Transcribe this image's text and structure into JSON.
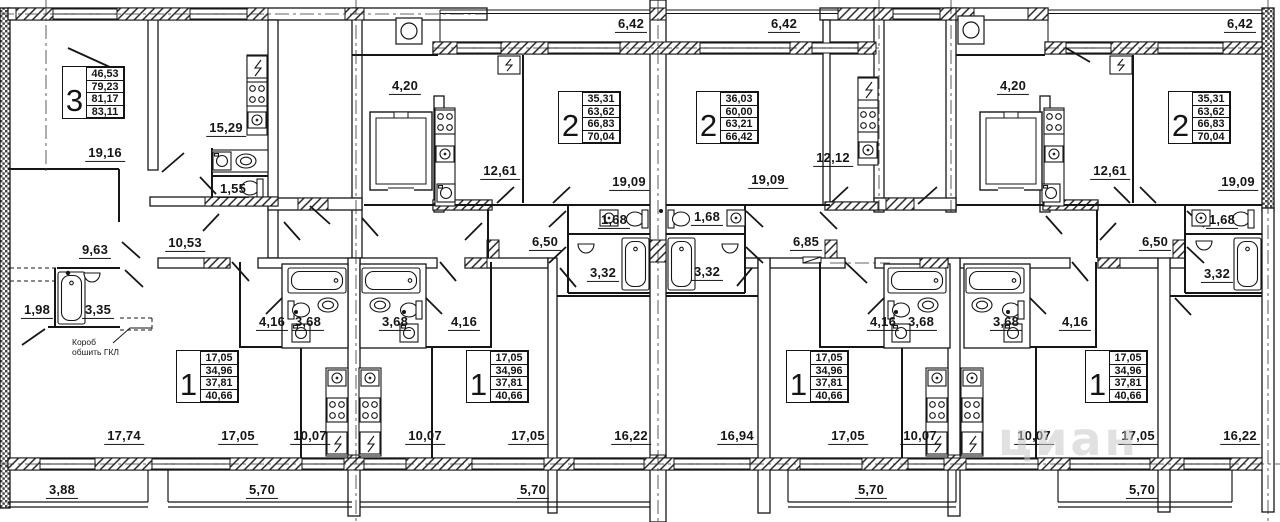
{
  "plan": {
    "title": "Floor plan with apartment layouts",
    "apartment_tables": [
      {
        "number": "3",
        "areas": [
          "46,53",
          "79,23",
          "81,17",
          "83,11"
        ],
        "x": 62,
        "y": 66
      },
      {
        "number": "2",
        "areas": [
          "35,31",
          "63,62",
          "66,83",
          "70,04"
        ],
        "x": 558,
        "y": 91
      },
      {
        "number": "2",
        "areas": [
          "36,03",
          "60,00",
          "63,21",
          "66,42"
        ],
        "x": 696,
        "y": 91
      },
      {
        "number": "2",
        "areas": [
          "35,31",
          "63,62",
          "66,83",
          "70,04"
        ],
        "x": 1168,
        "y": 91
      },
      {
        "number": "1",
        "areas": [
          "17,05",
          "34,96",
          "37,81",
          "40,66"
        ],
        "x": 176,
        "y": 350
      },
      {
        "number": "1",
        "areas": [
          "17,05",
          "34,96",
          "37,81",
          "40,66"
        ],
        "x": 466,
        "y": 350
      },
      {
        "number": "1",
        "areas": [
          "17,05",
          "34,96",
          "37,81",
          "40,66"
        ],
        "x": 786,
        "y": 350
      },
      {
        "number": "1",
        "areas": [
          "17,05",
          "34,96",
          "37,81",
          "40,66"
        ],
        "x": 1085,
        "y": 350
      }
    ],
    "dimension_labels": [
      {
        "text": "6,42",
        "x": 631,
        "y": 26
      },
      {
        "text": "6,42",
        "x": 784,
        "y": 26
      },
      {
        "text": "6,42",
        "x": 1240,
        "y": 26
      },
      {
        "text": "4,20",
        "x": 405,
        "y": 88
      },
      {
        "text": "4,20",
        "x": 1013,
        "y": 88
      },
      {
        "text": "15,29",
        "x": 226,
        "y": 130
      },
      {
        "text": "12,61",
        "x": 500,
        "y": 173
      },
      {
        "text": "12,12",
        "x": 833,
        "y": 160
      },
      {
        "text": "12,61",
        "x": 1110,
        "y": 173
      },
      {
        "text": "19,16",
        "x": 105,
        "y": 155
      },
      {
        "text": "19,09",
        "x": 629,
        "y": 184
      },
      {
        "text": "19,09",
        "x": 768,
        "y": 182
      },
      {
        "text": "19,09",
        "x": 1238,
        "y": 184
      },
      {
        "text": "1,55",
        "x": 233,
        "y": 191
      },
      {
        "text": "1,68",
        "x": 614,
        "y": 222
      },
      {
        "text": "1,68",
        "x": 707,
        "y": 219
      },
      {
        "text": "1,68",
        "x": 1222,
        "y": 222
      },
      {
        "text": "10,53",
        "x": 185,
        "y": 245
      },
      {
        "text": "9,63",
        "x": 95,
        "y": 252
      },
      {
        "text": "6,50",
        "x": 545,
        "y": 244
      },
      {
        "text": "6,85",
        "x": 806,
        "y": 244
      },
      {
        "text": "6,50",
        "x": 1155,
        "y": 244
      },
      {
        "text": "3,32",
        "x": 603,
        "y": 275
      },
      {
        "text": "3,32",
        "x": 707,
        "y": 274
      },
      {
        "text": "3,32",
        "x": 1217,
        "y": 276
      },
      {
        "text": "1,98",
        "x": 37,
        "y": 312
      },
      {
        "text": "3,35",
        "x": 98,
        "y": 312
      },
      {
        "text": "4,16",
        "x": 272,
        "y": 324
      },
      {
        "text": "3,68",
        "x": 308,
        "y": 324
      },
      {
        "text": "3,68",
        "x": 395,
        "y": 324
      },
      {
        "text": "4,16",
        "x": 464,
        "y": 324
      },
      {
        "text": "4,16",
        "x": 883,
        "y": 324
      },
      {
        "text": "3,68",
        "x": 921,
        "y": 324
      },
      {
        "text": "3,68",
        "x": 1006,
        "y": 324
      },
      {
        "text": "4,16",
        "x": 1075,
        "y": 324
      },
      {
        "text": "17,74",
        "x": 124,
        "y": 438
      },
      {
        "text": "17,05",
        "x": 238,
        "y": 438
      },
      {
        "text": "10,07",
        "x": 310,
        "y": 438
      },
      {
        "text": "10,07",
        "x": 425,
        "y": 438
      },
      {
        "text": "17,05",
        "x": 528,
        "y": 438
      },
      {
        "text": "16,22",
        "x": 631,
        "y": 438
      },
      {
        "text": "16,94",
        "x": 737,
        "y": 438
      },
      {
        "text": "17,05",
        "x": 848,
        "y": 438
      },
      {
        "text": "10,07",
        "x": 920,
        "y": 438
      },
      {
        "text": "10,07",
        "x": 1034,
        "y": 438
      },
      {
        "text": "17,05",
        "x": 1138,
        "y": 438
      },
      {
        "text": "16,22",
        "x": 1240,
        "y": 438
      },
      {
        "text": "3,88",
        "x": 62,
        "y": 492
      },
      {
        "text": "5,70",
        "x": 262,
        "y": 492
      },
      {
        "text": "5,70",
        "x": 533,
        "y": 492
      },
      {
        "text": "5,70",
        "x": 871,
        "y": 492
      },
      {
        "text": "5,70",
        "x": 1142,
        "y": 492
      }
    ],
    "note": {
      "line1": "Короб",
      "line2": "обшить ГКЛ"
    },
    "watermark": {
      "text": "циан"
    },
    "line_color": "#161616",
    "watermark_color": "#c9c9c9"
  }
}
